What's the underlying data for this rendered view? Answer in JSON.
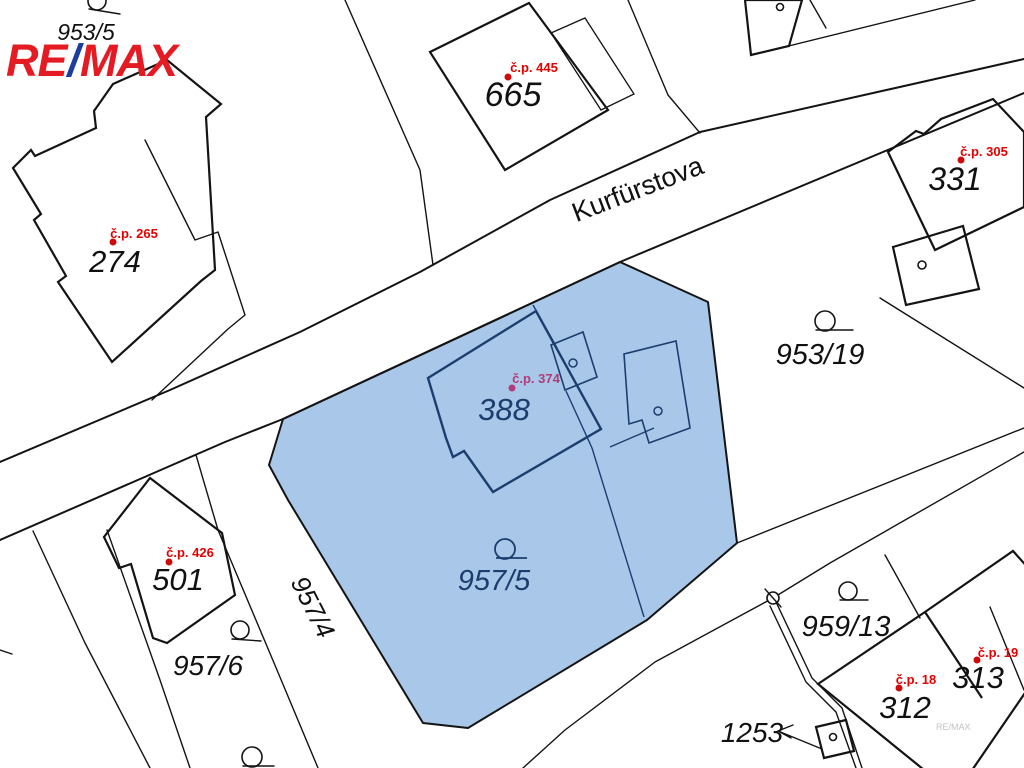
{
  "colors": {
    "highlight_fill": "#a9c7e8",
    "highlight_line": "#1c3e6e",
    "cp_red": "#e60000",
    "cp_purple": "#b13c7a",
    "dot_red": "#cf0a0a",
    "logo_red": "#e51b24",
    "logo_blue": "#1c3f9e"
  },
  "logo": {
    "re": "RE",
    "slash": "/",
    "max": "MAX"
  },
  "street": {
    "name": "Kurfürstova"
  },
  "watermark": "RE/MAX",
  "parcels": {
    "p953_5": "953/5",
    "p953_19": "953/19",
    "p957_5": "957/5",
    "p957_6": "957/6",
    "p957_4": "957/4",
    "p959_13": "959/13",
    "p1253": "1253"
  },
  "buildings": {
    "b274": {
      "number": "274",
      "cp": "č.p. 265"
    },
    "b665": {
      "number": "665",
      "cp": "č.p. 445"
    },
    "b331": {
      "number": "331",
      "cp": "č.p. 305"
    },
    "b388": {
      "number": "388",
      "cp": "č.p. 374"
    },
    "b501": {
      "number": "501",
      "cp": "č.p. 426"
    },
    "b312": {
      "number": "312",
      "cp": "č.p. 18"
    },
    "b313": {
      "number": "313",
      "cp": "č.p. 19"
    }
  }
}
